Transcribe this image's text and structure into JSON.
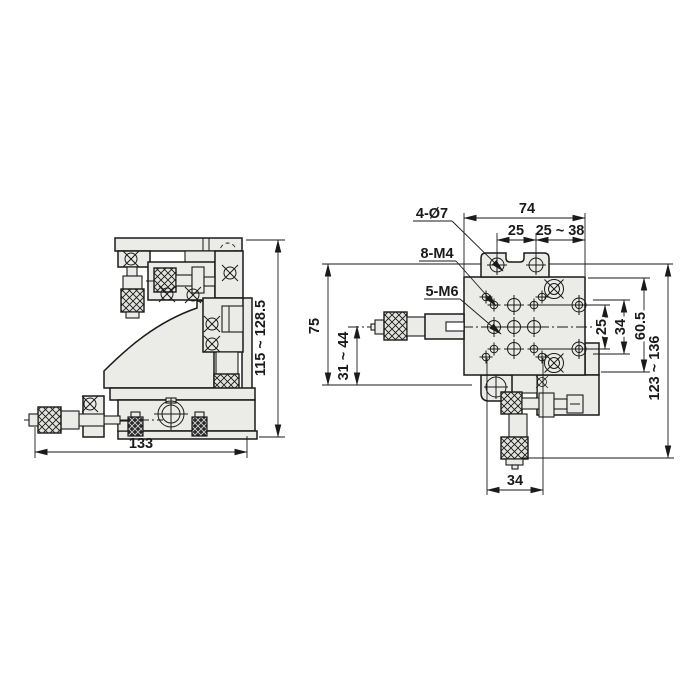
{
  "side_view": {
    "dim_width": "133",
    "dim_height_range": "115 ~ 128.5"
  },
  "front_view": {
    "dim_top_width": "74",
    "dim_hole_pitch_top": "25",
    "dim_travel_top": "25 ~ 38",
    "label_through_holes": "4-Ø7",
    "label_tapped_m4": "8-M4",
    "label_tapped_m6": "5-M6",
    "dim_left_height": "75",
    "dim_travel_left": "31 ~ 44",
    "dim_right_pitch": "25",
    "dim_right_span": "34",
    "dim_right_height": "60.5",
    "dim_travel_right": "123 ~ 136",
    "dim_bottom_width": "34"
  },
  "colors": {
    "line": "#1a1a1a",
    "metal_fill": "#ebebe8",
    "background": "#ffffff"
  }
}
